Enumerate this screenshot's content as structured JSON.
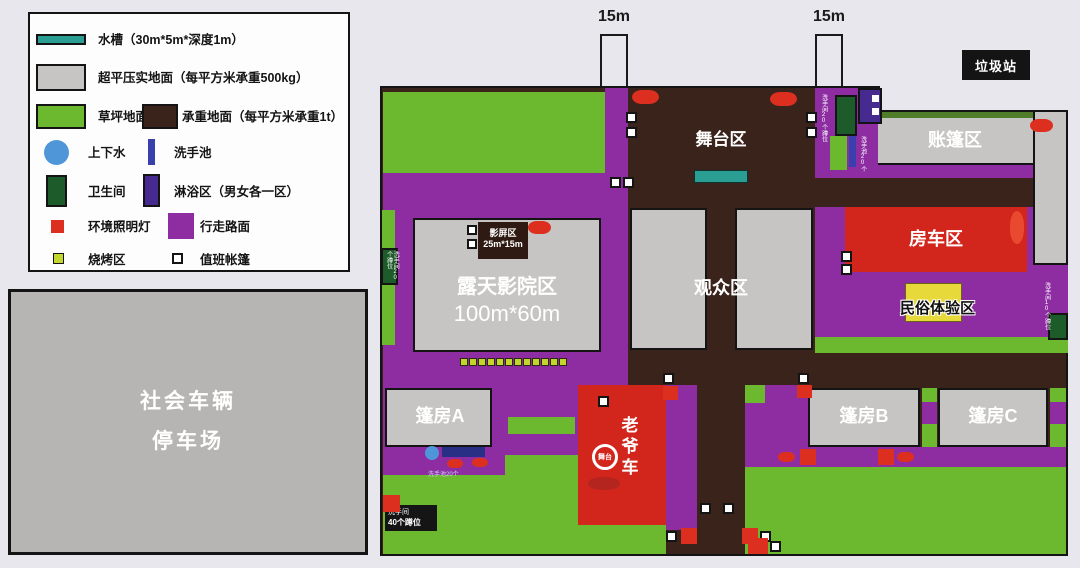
{
  "colors": {
    "background": "#e8e7ed",
    "walkway_purple": "#8e2da2",
    "lawn_green": "#6cb92f",
    "load_bearing_brown": "#3a231b",
    "compacted_gray": "#c7c5c3",
    "water_trough_teal": "#2b9e94",
    "water_supply_blue": "#4f96d8",
    "wash_basin_indigo": "#3a3fae",
    "toilet_dark_green": "#1e5b2a",
    "shower_dark_purple": "#472a8f",
    "light_red": "#dd2f1f",
    "rv_red": "#d2251c",
    "bbq_yellow_green": "#c3d62e",
    "folk_yellow": "#e8d93a"
  },
  "legend": {
    "items": [
      {
        "label": "水槽（30m*5m*深度1m）"
      },
      {
        "label": "超平压实地面（每平方米承重500kg）"
      },
      {
        "label": "草坪地面"
      },
      {
        "label": "承重地面（每平方米承重1t）"
      },
      {
        "label": "上下水"
      },
      {
        "label": "洗手池"
      },
      {
        "label": "卫生间"
      },
      {
        "label": "淋浴区（男女各一区）"
      },
      {
        "label": "环境照明灯"
      },
      {
        "label": "行走路面"
      },
      {
        "label": "烧烤区"
      },
      {
        "label": "值班帐篷"
      }
    ]
  },
  "parking": {
    "line1": "社会车辆",
    "line2": "停车场"
  },
  "top": {
    "gate_left": "15m",
    "gate_right": "15m",
    "garbage": "垃圾站"
  },
  "map": {
    "stage": "舞台区",
    "audience": "观众区",
    "cinema": "露天影院区",
    "cinema_size": "100m*60m",
    "screen": "影屏区",
    "screen_size": "25m*15m",
    "tent_area": "账篷区",
    "rv": "房车区",
    "folk": "民俗体验区",
    "tent_a": "篷房A",
    "tent_b": "篷房B",
    "tent_c": "篷房C",
    "vintage_car": "老爷车",
    "car_circle": "舞台",
    "bbq_count": 12,
    "micro": {
      "toilet_left": "洗手间20个蹲位",
      "toilet_top": "洗手间20个蹲位",
      "basin_top": "洗手池20个",
      "basin_bottom": "洗手池20个",
      "toilet_bottom_l1": "洗手间",
      "toilet_bottom_l2": "40个蹲位",
      "toilet_right": "洗手间10个蹲位"
    }
  }
}
